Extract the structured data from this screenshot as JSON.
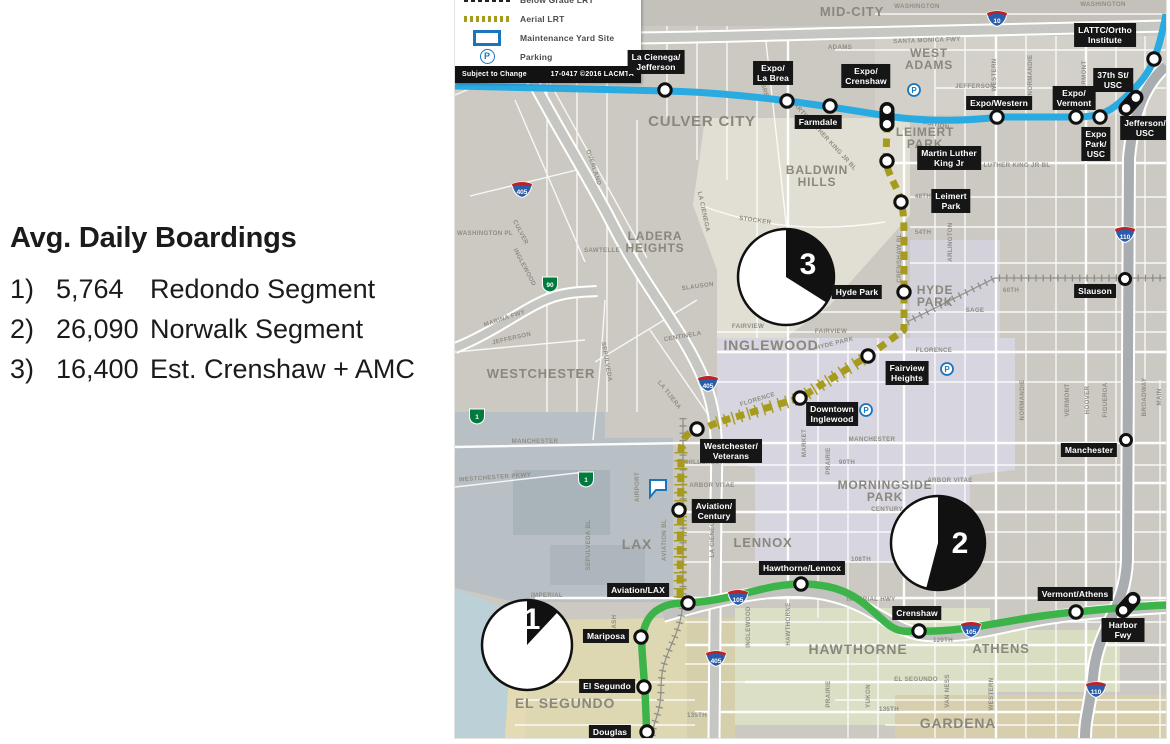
{
  "boardings": {
    "title": "Avg. Daily Boardings",
    "items": [
      {
        "num": "1)",
        "value": "5,764",
        "label": "Redondo Segment"
      },
      {
        "num": "2)",
        "value": "26,090",
        "label": "Norwalk Segment"
      },
      {
        "num": "3)",
        "value": "16,400",
        "label": "Est. Crenshaw + AMC"
      }
    ]
  },
  "chart_data": {
    "type": "pie",
    "title": "Avg. Daily Boardings",
    "series": [
      {
        "id": 1,
        "segment": "Redondo Segment",
        "value": 5764,
        "black_wedge_share": 0.119
      },
      {
        "id": 2,
        "segment": "Norwalk Segment",
        "value": 26090,
        "black_wedge_share": 0.541
      },
      {
        "id": 3,
        "segment": "Est. Crenshaw + AMC",
        "value": 16400,
        "black_wedge_share": 0.34
      }
    ],
    "note": "Three numbered pies overlaid on map; black wedge = segment share of 48,254 total, starting at 12 o'clock clockwise."
  },
  "legend": {
    "items": [
      {
        "swatch": "dash-black",
        "label": "Below Grade LRT"
      },
      {
        "swatch": "dash-olive",
        "label": "Aerial LRT"
      },
      {
        "swatch": "yard",
        "label": "Maintenance Yard Site"
      },
      {
        "swatch": "parking",
        "label": "Parking",
        "glyph": "P"
      }
    ],
    "footer_left": "Subject to Change",
    "footer_right": "17-0417 ©2016 LACMTA"
  },
  "map": {
    "colors": {
      "expo_line": "#29abe2",
      "green_line": "#3cb44a",
      "crenshaw_line": "#a79b1e",
      "station_label_bg": "#161616",
      "parking_blue": "#1b75bb",
      "neighborhood_text": "#8a887c",
      "street_text": "#8f8d84",
      "interstate_blue": "#2a5caa",
      "interstate_red": "#bf2026",
      "state_green": "#007b3d"
    },
    "lines": [
      {
        "id": "expo",
        "name": "Expo Line"
      },
      {
        "id": "crenshaw",
        "name": "Crenshaw/LAX Line (dashed, under construction)"
      },
      {
        "id": "green",
        "name": "Green Line"
      }
    ],
    "neighborhoods": [
      [
        "MID-CITY",
        397,
        16,
        13
      ],
      [
        "WEST\nADAMS",
        474,
        57,
        12
      ],
      [
        "CULVER CITY",
        247,
        126,
        15
      ],
      [
        "BALDWIN\nHILLS",
        362,
        174,
        12
      ],
      [
        "LADERA\nHEIGHTS",
        200,
        240,
        12
      ],
      [
        "LEIMERT\nPARK",
        470,
        136,
        12
      ],
      [
        "HYDE\nPARK",
        480,
        294,
        12
      ],
      [
        "INGLEWOOD",
        316,
        350,
        14
      ],
      [
        "WESTCHESTER",
        86,
        378,
        13
      ],
      [
        "MORNINGSIDE\nPARK",
        430,
        489,
        12
      ],
      [
        "LAX",
        182,
        549,
        14
      ],
      [
        "LENNOX",
        308,
        547,
        13
      ],
      [
        "HAWTHORNE",
        403,
        654,
        14
      ],
      [
        "ATHENS",
        546,
        653,
        13
      ],
      [
        "GARDENA",
        503,
        728,
        14
      ],
      [
        "EL SEGUNDO",
        110,
        708,
        14
      ]
    ],
    "streets": [
      [
        "WASHINGTON",
        462,
        8,
        0
      ],
      [
        "WASHINGTON",
        648,
        6,
        0
      ],
      [
        "SANTA MONICA FWY",
        472,
        42,
        -2
      ],
      [
        "ADAMS",
        385,
        49,
        0
      ],
      [
        "JEFFERSON",
        520,
        88,
        0
      ],
      [
        "WESTERN",
        541,
        75,
        -90
      ],
      [
        "NORMANDIE",
        577,
        75,
        -90
      ],
      [
        "VERMONT",
        631,
        77,
        -90
      ],
      [
        "EXPOSITION",
        474,
        125,
        12
      ],
      [
        "MARTIN LUTHER KING JR BL",
        548,
        167,
        0
      ],
      [
        "MARTIN LUTHER KING JR BL",
        367,
        136,
        47
      ],
      [
        "STOCKER",
        300,
        222,
        8
      ],
      [
        "CRENSHAW BL",
        446,
        258,
        -90
      ],
      [
        "ARLINGTON",
        497,
        242,
        -90
      ],
      [
        "48TH",
        468,
        198,
        0
      ],
      [
        "54TH",
        468,
        234,
        0
      ],
      [
        "60TH",
        556,
        292,
        0
      ],
      [
        "SAGE",
        520,
        312,
        0
      ],
      [
        "SLAUSON",
        243,
        288,
        -8
      ],
      [
        "FAIRVIEW",
        293,
        328,
        0
      ],
      [
        "FAIRVIEW",
        376,
        333,
        0
      ],
      [
        "LA BREA",
        331,
        258,
        -90
      ],
      [
        "LA BREA",
        307,
        88,
        72
      ],
      [
        "CENTINELA",
        228,
        338,
        -10
      ],
      [
        "LA TIJERA",
        213,
        396,
        52
      ],
      [
        "SEPULVEDA",
        150,
        362,
        80
      ],
      [
        "JEFFERSON",
        57,
        340,
        -13
      ],
      [
        "MARINA FWY",
        50,
        320,
        -18
      ],
      [
        "WESTCHESTER PKWY",
        40,
        479,
        -4
      ],
      [
        "MANCHESTER",
        80,
        443,
        0
      ],
      [
        "MANCHESTER",
        417,
        441,
        0
      ],
      [
        "FLORENCE",
        303,
        401,
        -17
      ],
      [
        "FLORENCE",
        479,
        352,
        0
      ],
      [
        "90TH",
        392,
        464,
        0
      ],
      [
        "HILLCREST",
        250,
        464,
        0
      ],
      [
        "ARBOR VITAE",
        257,
        487,
        0
      ],
      [
        "ARBOR VITAE",
        495,
        482,
        0
      ],
      [
        "CENTURY",
        432,
        511,
        0
      ],
      [
        "108TH",
        406,
        561,
        0
      ],
      [
        "AIRPORT",
        184,
        487,
        -90
      ],
      [
        "AVIATION BL",
        211,
        540,
        -90
      ],
      [
        "LA CIENEGA",
        259,
        537,
        -90
      ],
      [
        "SEPULVEDA BL",
        135,
        545,
        -90
      ],
      [
        "MARKET",
        351,
        443,
        -90
      ],
      [
        "PRAIRIE",
        375,
        461,
        -90
      ],
      [
        "NASH",
        161,
        624,
        -90
      ],
      [
        "IMPERIAL",
        92,
        597,
        0
      ],
      [
        "IMPERIAL HWY",
        416,
        601,
        0
      ],
      [
        "120TH",
        488,
        642,
        0
      ],
      [
        "EL SEGUNDO",
        461,
        681,
        0
      ],
      [
        "135TH",
        434,
        711,
        0
      ],
      [
        "135TH",
        242,
        717,
        0
      ],
      [
        "INGLEWOOD",
        295,
        627,
        -90
      ],
      [
        "HAWTHORNE",
        335,
        624,
        -90
      ],
      [
        "PRAIRIE",
        375,
        694,
        -90
      ],
      [
        "YUKON",
        415,
        696,
        -90
      ],
      [
        "VAN NESS",
        494,
        691,
        -90
      ],
      [
        "WESTERN",
        538,
        694,
        -90
      ],
      [
        "NORMANDIE",
        569,
        400,
        -90
      ],
      [
        "VERMONT",
        614,
        400,
        -90
      ],
      [
        "HOOVER",
        634,
        400,
        -90
      ],
      [
        "FIGUEROA",
        652,
        400,
        -90
      ],
      [
        "BROADWAY",
        691,
        397,
        -90
      ],
      [
        "MAIN",
        706,
        397,
        -90
      ],
      [
        "OVERLAND",
        137,
        168,
        72
      ],
      [
        "SAWTELLE",
        147,
        252,
        0
      ],
      [
        "CULVER",
        64,
        233,
        62
      ],
      [
        "WASHINGTON PL",
        30,
        235,
        0
      ],
      [
        "INGLEWOOD",
        68,
        268,
        62
      ],
      [
        "LA CIENEGA",
        247,
        212,
        78
      ],
      [
        "HYDE PARK",
        380,
        345,
        -14
      ]
    ],
    "shields": [
      {
        "t": "i",
        "n": "10",
        "x": 542,
        "y": 17
      },
      {
        "t": "i",
        "n": "405",
        "x": 67,
        "y": 188
      },
      {
        "t": "i",
        "n": "405",
        "x": 253,
        "y": 382
      },
      {
        "t": "i",
        "n": "405",
        "x": 261,
        "y": 657
      },
      {
        "t": "i",
        "n": "110",
        "x": 670,
        "y": 233
      },
      {
        "t": "i",
        "n": "110",
        "x": 641,
        "y": 688
      },
      {
        "t": "i",
        "n": "105",
        "x": 283,
        "y": 596
      },
      {
        "t": "i",
        "n": "105",
        "x": 516,
        "y": 628
      },
      {
        "t": "s",
        "n": "90",
        "x": 95,
        "y": 283
      },
      {
        "t": "s",
        "n": "1",
        "x": 22,
        "y": 415
      },
      {
        "t": "s",
        "n": "1",
        "x": 131,
        "y": 478
      }
    ],
    "stations": [
      {
        "name": "La Cienega/Jefferson",
        "line": "expo",
        "kind": "circle",
        "x": 210,
        "y": 90,
        "label": {
          "lines": [
            "La Cienega/",
            "Jefferson"
          ],
          "x": 201,
          "y": 62
        }
      },
      {
        "name": "Expo/La Brea",
        "line": "expo",
        "kind": "circle",
        "x": 332,
        "y": 101,
        "label": {
          "lines": [
            "Expo/",
            "La Brea"
          ],
          "x": 318,
          "y": 73
        }
      },
      {
        "name": "Farmdale",
        "line": "expo",
        "kind": "circle",
        "x": 375,
        "y": 106,
        "label": {
          "lines": [
            "Farmdale"
          ],
          "x": 363,
          "y": 122
        }
      },
      {
        "name": "Expo/Crenshaw",
        "line": "expo",
        "kind": "pill",
        "x": 432,
        "y": 117,
        "rot": 0,
        "label": {
          "lines": [
            "Expo/",
            "Crenshaw"
          ],
          "x": 411,
          "y": 76
        },
        "parking": [
          459,
          90
        ]
      },
      {
        "name": "Expo/Western",
        "line": "expo",
        "kind": "circle",
        "x": 542,
        "y": 117,
        "label": {
          "lines": [
            "Expo/Western"
          ],
          "x": 544,
          "y": 103
        }
      },
      {
        "name": "Expo/Vermont",
        "line": "expo",
        "kind": "circle",
        "x": 621,
        "y": 117,
        "label": {
          "lines": [
            "Expo/",
            "Vermont"
          ],
          "x": 619,
          "y": 98
        }
      },
      {
        "name": "Expo Park/USC",
        "line": "expo",
        "kind": "circle",
        "x": 645,
        "y": 117,
        "label": {
          "lines": [
            "Expo",
            "Park/",
            "USC"
          ],
          "x": 641,
          "y": 144
        }
      },
      {
        "name": "37th St/USC – Jefferson/USC",
        "line": "expo",
        "kind": "pill",
        "x": 676,
        "y": 103,
        "rot": 42,
        "label": {
          "lines": [
            "37th St/",
            "USC"
          ],
          "x": 658,
          "y": 80
        },
        "label2": {
          "lines": [
            "Jefferson/",
            "USC"
          ],
          "x": 690,
          "y": 128
        }
      },
      {
        "name": "LATTC/Ortho Institute",
        "line": "expo",
        "kind": "circle",
        "x": 699,
        "y": 59,
        "label": {
          "lines": [
            "LATTC/Ortho",
            "Institute"
          ],
          "x": 650,
          "y": 35
        }
      },
      {
        "name": "Martin Luther King Jr",
        "line": "crenshaw",
        "kind": "circle",
        "x": 432,
        "y": 161,
        "label": {
          "lines": [
            "Martin Luther",
            "King Jr"
          ],
          "x": 494,
          "y": 158
        }
      },
      {
        "name": "Leimert Park",
        "line": "crenshaw",
        "kind": "circle",
        "x": 446,
        "y": 202,
        "label": {
          "lines": [
            "Leimert",
            "Park"
          ],
          "x": 496,
          "y": 201
        }
      },
      {
        "name": "Hyde Park",
        "line": "crenshaw",
        "kind": "circle",
        "x": 449,
        "y": 292,
        "label": {
          "lines": [
            "Hyde Park"
          ],
          "x": 402,
          "y": 292
        }
      },
      {
        "name": "Fairview Heights",
        "line": "crenshaw",
        "kind": "circle",
        "x": 413,
        "y": 356,
        "label": {
          "lines": [
            "Fairview",
            "Heights"
          ],
          "x": 452,
          "y": 373
        },
        "parking": [
          492,
          369
        ]
      },
      {
        "name": "Downtown Inglewood",
        "line": "crenshaw",
        "kind": "circle",
        "x": 345,
        "y": 398,
        "label": {
          "lines": [
            "Downtown",
            "Inglewood"
          ],
          "x": 377,
          "y": 414
        },
        "parking": [
          411,
          410
        ]
      },
      {
        "name": "Westchester/Veterans",
        "line": "crenshaw",
        "kind": "circle",
        "x": 242,
        "y": 429,
        "label": {
          "lines": [
            "Westchester/",
            "Veterans"
          ],
          "x": 276,
          "y": 451
        }
      },
      {
        "name": "Aviation/Century",
        "line": "crenshaw",
        "kind": "circle",
        "x": 224,
        "y": 510,
        "label": {
          "lines": [
            "Aviation/",
            "Century"
          ],
          "x": 259,
          "y": 511
        }
      },
      {
        "name": "Aviation/LAX",
        "line": "crenshaw green",
        "kind": "circle",
        "x": 233,
        "y": 603,
        "label": {
          "lines": [
            "Aviation/LAX"
          ],
          "x": 183,
          "y": 590
        }
      },
      {
        "name": "Hawthorne/Lennox",
        "line": "green",
        "kind": "circle",
        "x": 346,
        "y": 584,
        "label": {
          "lines": [
            "Hawthorne/Lennox"
          ],
          "x": 347,
          "y": 568
        }
      },
      {
        "name": "Crenshaw",
        "line": "green",
        "kind": "circle",
        "x": 464,
        "y": 631,
        "label": {
          "lines": [
            "Crenshaw"
          ],
          "x": 462,
          "y": 613
        }
      },
      {
        "name": "Vermont/Athens",
        "line": "green",
        "kind": "circle",
        "x": 621,
        "y": 612,
        "label": {
          "lines": [
            "Vermont/Athens"
          ],
          "x": 620,
          "y": 594
        }
      },
      {
        "name": "Harbor Fwy",
        "line": "green",
        "kind": "pill",
        "x": 673,
        "y": 605,
        "rot": 42,
        "label": {
          "lines": [
            "Harbor Fwy"
          ],
          "x": 668,
          "y": 630
        }
      },
      {
        "name": "Mariposa",
        "line": "green",
        "kind": "circle",
        "x": 186,
        "y": 637,
        "label": {
          "lines": [
            "Mariposa"
          ],
          "x": 151,
          "y": 636
        }
      },
      {
        "name": "El Segundo",
        "line": "green",
        "kind": "circle",
        "x": 189,
        "y": 687,
        "label": {
          "lines": [
            "El Segundo"
          ],
          "x": 152,
          "y": 686
        }
      },
      {
        "name": "Douglas",
        "line": "green",
        "kind": "circle",
        "x": 192,
        "y": 732,
        "label": {
          "lines": [
            "Douglas"
          ],
          "x": 155,
          "y": 732
        }
      },
      {
        "name": "Slauson",
        "line": "rail",
        "kind": "circle",
        "x": 670,
        "y": 279,
        "label": {
          "lines": [
            "Slauson"
          ],
          "x": 640,
          "y": 291
        }
      },
      {
        "name": "Manchester",
        "line": "rail",
        "kind": "circle",
        "x": 671,
        "y": 440,
        "label": {
          "lines": [
            "Manchester"
          ],
          "x": 634,
          "y": 450
        }
      }
    ],
    "pies": [
      {
        "id": "1",
        "value": 5764,
        "cx": 72,
        "cy": 645,
        "r": 45,
        "num": [
          77,
          619
        ]
      },
      {
        "id": "2",
        "value": 26090,
        "cx": 483,
        "cy": 543,
        "r": 47,
        "num": [
          505,
          543
        ]
      },
      {
        "id": "3",
        "value": 16400,
        "cx": 331,
        "cy": 277,
        "r": 48,
        "num": [
          353,
          264
        ]
      }
    ],
    "yard_marker": {
      "x": 195,
      "y": 480
    }
  }
}
